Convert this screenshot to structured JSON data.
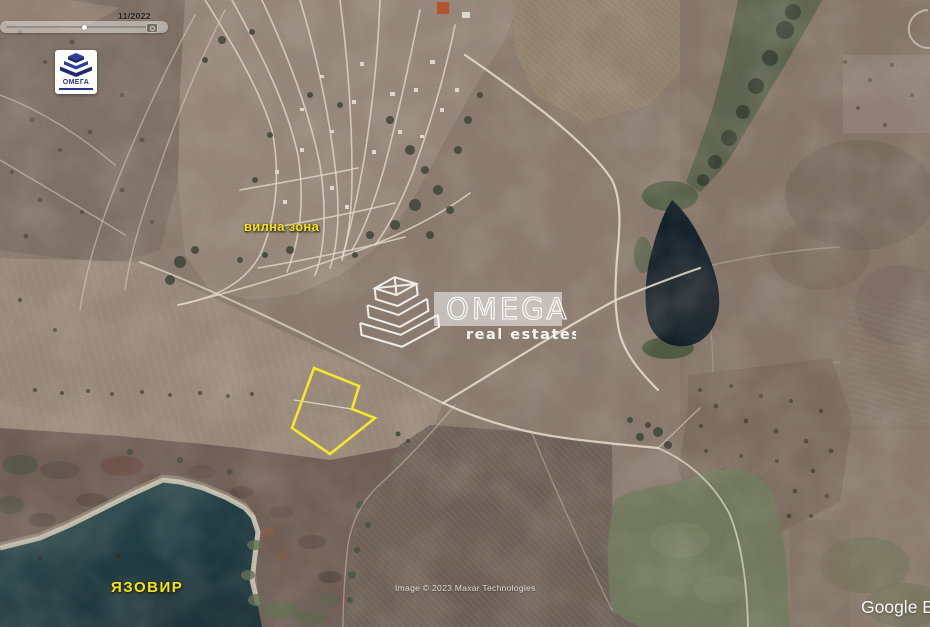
{
  "ui": {
    "time_slider": {
      "date": "11/2022"
    },
    "logo": {
      "text": "ОМЕГА"
    },
    "attribution": "Image © 2023 Maxar Technologies",
    "google_watermark": "Google E"
  },
  "watermark": {
    "brand": "OMEGA",
    "tagline": "real estates"
  },
  "map_labels": {
    "villa_zone": "вилна зона",
    "reservoir": "ЯЗОВИР"
  },
  "parcel": {
    "points": "314,368 359,386 352,409 375,418 330,454 292,428",
    "divider_points": "294,400 352,409",
    "outline_color": "#f2e72b"
  },
  "colors": {
    "label_yellow": "#f2e31f",
    "parcel_yellow": "#f2e72b",
    "brand_navy": "#27348b",
    "water_lake": "#1b363c",
    "water_pond": "#0f1d27",
    "terrain_base": "#8c7c70"
  }
}
